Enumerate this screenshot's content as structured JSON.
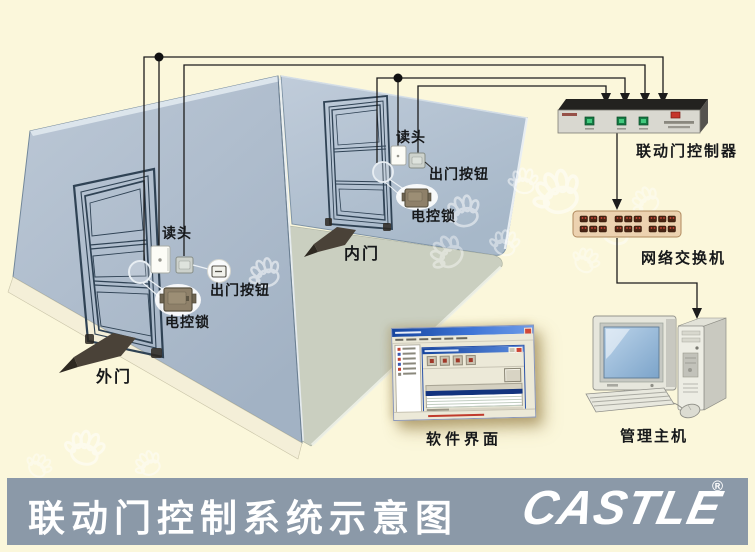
{
  "diagram": {
    "outer_door": {
      "name": "外门",
      "reader_label": "读头",
      "exit_button_label": "出门按钮",
      "lock_label": "电控锁"
    },
    "inner_door": {
      "name": "内门",
      "reader_label": "读头",
      "exit_button_label": "出门按钮",
      "lock_label": "电控锁"
    },
    "devices": {
      "controller": "联动门控制器",
      "network_switch": "网络交换机",
      "software_ui": "软件界面",
      "management_host": "管理主机"
    }
  },
  "footer": {
    "title": "联动门控制系统示意图",
    "brand": "CASTLE",
    "registered_mark": "®"
  },
  "colors": {
    "background": "#FBF7DB",
    "left_wall": "#ACBBCC",
    "far_wall": "#B5C3D3",
    "floor": "#CACFC0",
    "footer_bar": "#8B99A8",
    "wire": "#1C1C1C",
    "switch_body": "#ECD2B0",
    "controller_button_green": "#167A43",
    "controller_led_red": "#C5352B",
    "direction_arrow": "#4A4238"
  }
}
